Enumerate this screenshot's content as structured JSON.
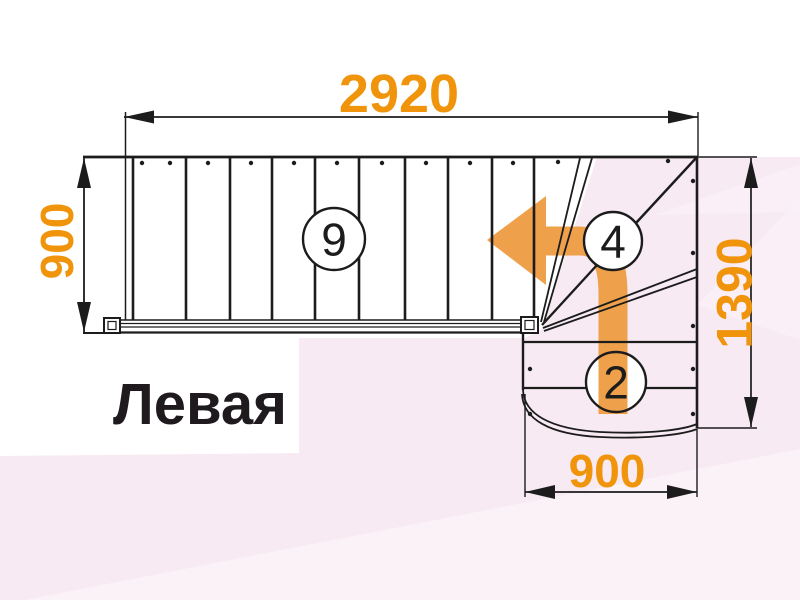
{
  "diagram": {
    "title": "Левая",
    "dimensions": {
      "top_length": "2920",
      "left_width": "900",
      "right_depth": "1390",
      "bottom_width": "900"
    },
    "step_counts": {
      "straight_flight": "9",
      "winder_flight": "4",
      "bottom_flight": "2"
    },
    "colors": {
      "dimension_text": "#F0940C",
      "direction_arrow": "#EFA04A",
      "linework": "#1C1C1C",
      "background_pink": "#F7EAF2",
      "background_pink_light": "#FBF2F8"
    }
  }
}
